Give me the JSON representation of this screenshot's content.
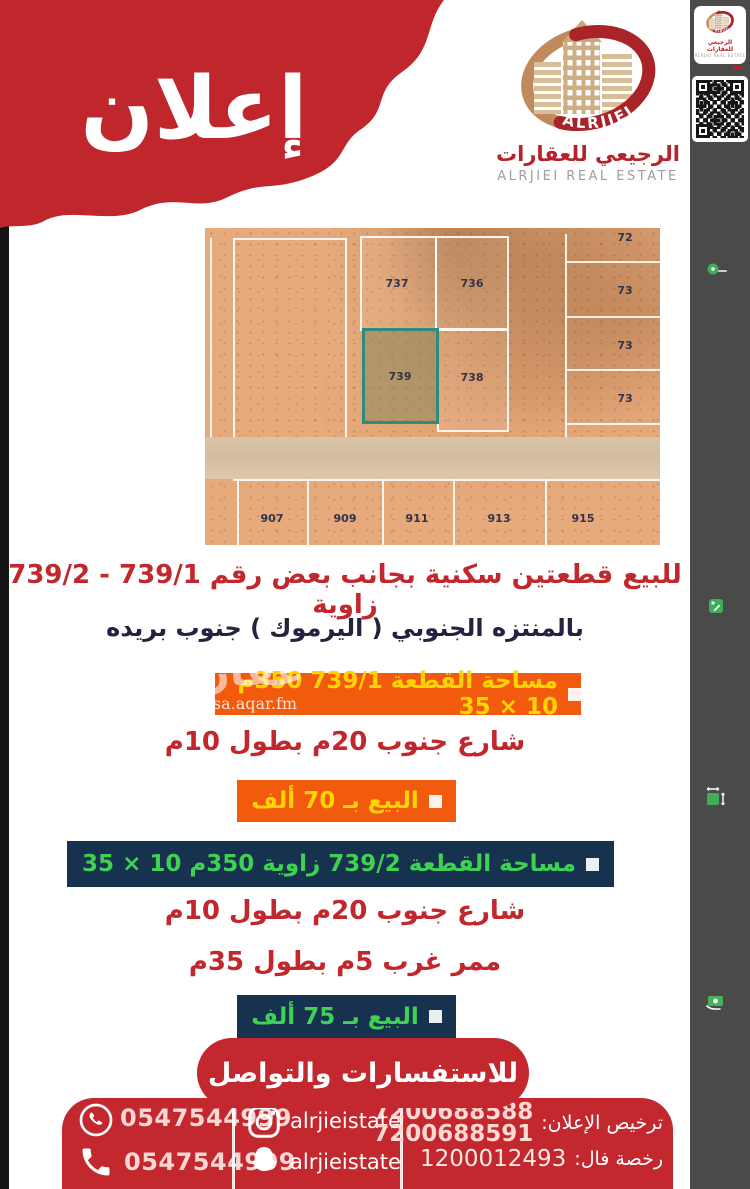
{
  "poster": {
    "announcement": "إعلان"
  },
  "brand": {
    "name_ar": "الرجيعي للعقارات",
    "name_en": "ALRJIEI REAL ESTATE",
    "logo_text": "ALRJIEI"
  },
  "sidebar": {
    "location": "بريدة - حي المنتزه الجنوبي",
    "listing_type": "أرض للبيع",
    "area": "350 م²",
    "price": "75 ألف"
  },
  "map": {
    "plots": {
      "p737": "737",
      "p736": "736",
      "p739": "739",
      "p738": "738"
    },
    "right": [
      "72",
      "73",
      "73",
      "73"
    ],
    "bottom": [
      "907",
      "909",
      "911",
      "913",
      "915"
    ]
  },
  "listing": {
    "title_line1": "للبيع قطعتين سكنية بجانب بعض رقم 739/1 - 739/2 زاوية",
    "title_line2": "بالمنتزه الجنوبي ( اليرموك ) جنوب بريده",
    "plot1": {
      "area_line": "مساحة القطعة 739/1 350م 10 × 35",
      "street_line": "شارع جنوب 20م بطول 10م",
      "price_line": "البيع بـ 70 ألف"
    },
    "plot2": {
      "area_line": "مساحة القطعة 739/2 زاوية 350م 10 × 35",
      "street_line": "شارع جنوب 20م بطول 10م",
      "passage_line": "ممر غرب 5م بطول 35م",
      "price_line": "البيع بـ 75 ألف"
    }
  },
  "contact": {
    "banner": "للاستفسارات والتواصل",
    "whatsapp": "0547544999",
    "phone": "0547544999",
    "instagram": "alrjieistate",
    "snapchat": "alrjieistate",
    "license_label": "ترخيص الإعلان:",
    "license_numbers": [
      "7200688588",
      "7200688591"
    ],
    "fal_label": "رخصة فال:",
    "fal_number": "1200012493"
  },
  "watermark": {
    "word": "عقار",
    "site": "sa.aqar.fm"
  },
  "colors": {
    "red": "#c1272d",
    "orange": "#f25a0e",
    "yellow": "#ffd401",
    "navy": "#17324e",
    "green": "#3ed153",
    "sidebar_gray": "#4a4a48",
    "teal": "#2d8c7c"
  }
}
